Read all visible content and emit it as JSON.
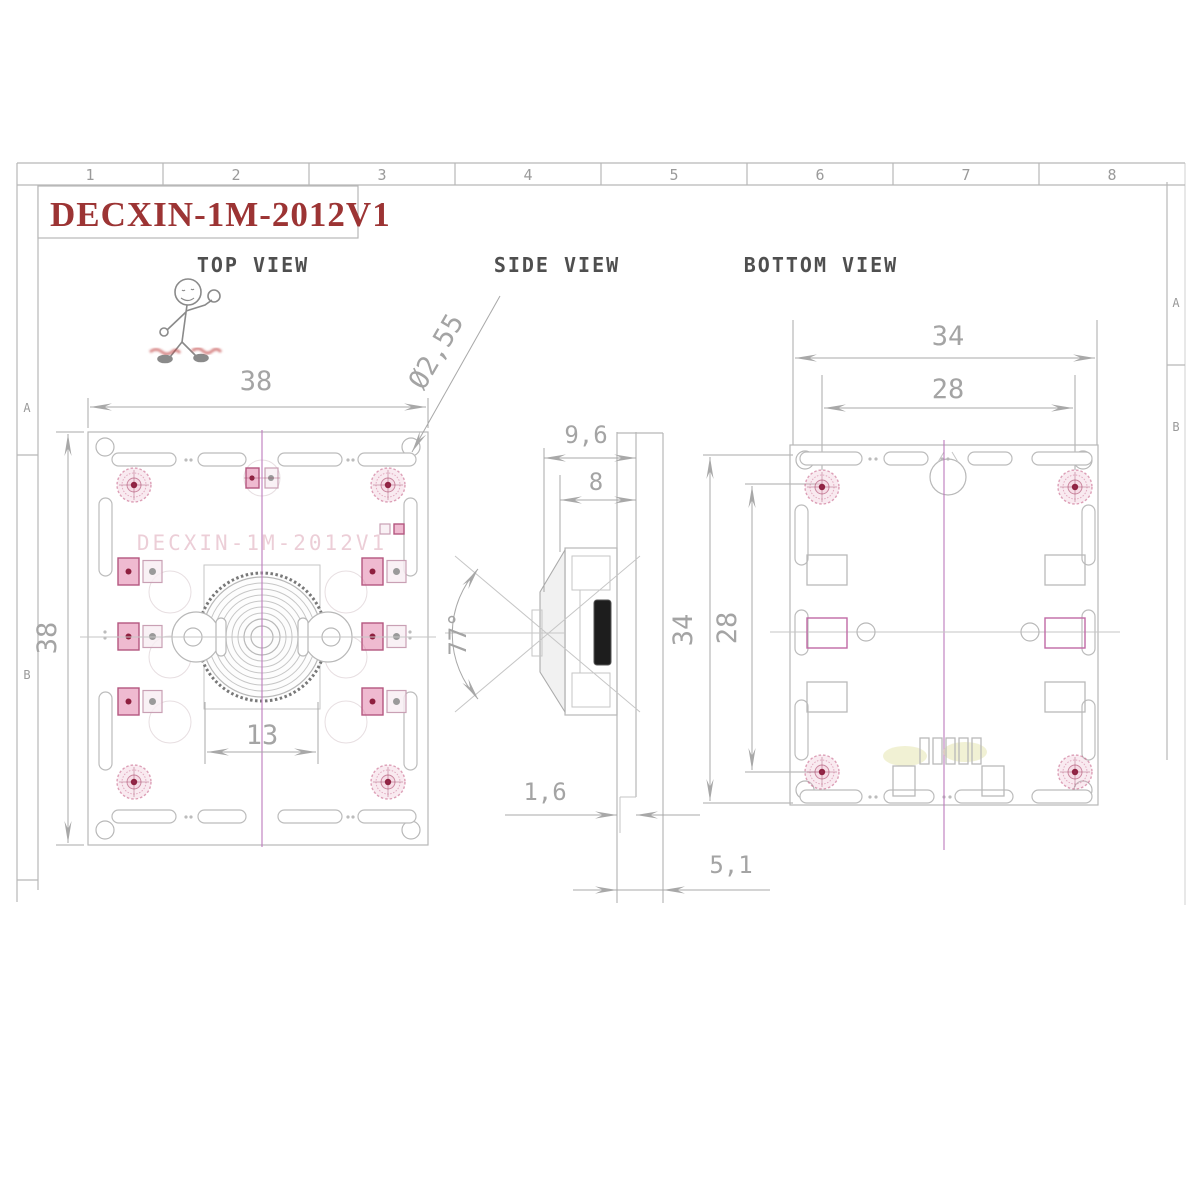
{
  "title_block": {
    "part_number": "DECXIN-1M-2012V1"
  },
  "frame": {
    "columns": [
      "1",
      "2",
      "3",
      "4",
      "5",
      "6",
      "7",
      "8"
    ],
    "zones_left": [
      "A",
      "B"
    ],
    "zones_right": [
      "A",
      "B"
    ]
  },
  "views": {
    "top": {
      "label": "TOP VIEW",
      "watermark": "DECXIN-1M-2012V1",
      "dims": {
        "width": "38",
        "height": "38",
        "lens_barrel": "13",
        "mount_hole": "Ø2,55"
      }
    },
    "side": {
      "label": "SIDE VIEW",
      "dims": {
        "lens_total_depth": "9,6",
        "lens_depth": "8",
        "fov_angle": "77°",
        "pcb_thickness": "1,6",
        "back_height": "5,1"
      }
    },
    "bottom": {
      "label": "BOTTOM VIEW",
      "dims": {
        "board_width": "34",
        "hole_pitch_h": "28",
        "board_height": "34",
        "hole_pitch_v": "28"
      }
    }
  },
  "colors": {
    "title_red": "#9c3434",
    "pad_pink": "#c2608a",
    "centerline_magenta": "#bd7abd",
    "line_gray": "#b8b8b8"
  }
}
